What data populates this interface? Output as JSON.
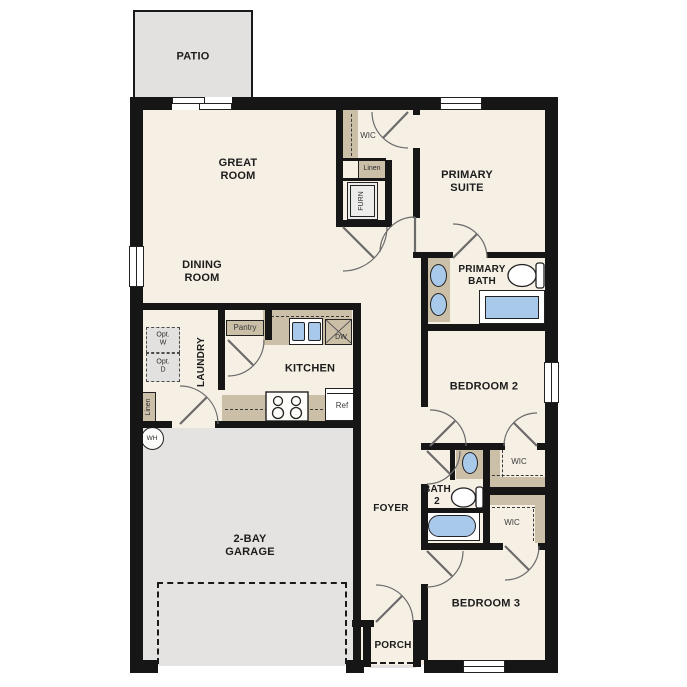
{
  "plan": {
    "title": "single-story floor plan",
    "colors": {
      "wall": "#161616",
      "floor": "#f5efe4",
      "exterior_concrete": "#e2e1df",
      "cabinetry_tan": "#cbbfa8",
      "plumbing_blue": "#a9c9ea",
      "label_text": "#1c1c1c"
    },
    "labels": {
      "patio": "PATIO",
      "great_room": "GREAT\nROOM",
      "dining_room": "DINING\nROOM",
      "primary_suite": "PRIMARY\nSUITE",
      "primary_bath": "PRIMARY\nBATH",
      "wic_primary": "WIC",
      "linen_hall": "Linen",
      "furnace": "FURN",
      "bedroom2": "BEDROOM 2",
      "wic_bedroom2": "WIC",
      "bath2": "BATH\n2",
      "foyer": "FOYER",
      "wic_bedroom3": "WIC",
      "bedroom3": "BEDROOM 3",
      "porch": "PORCH",
      "kitchen": "KITCHEN",
      "pantry": "Pantry",
      "laundry": "LAUNDRY",
      "opt_washer": "Opt.\nW",
      "opt_dryer": "Opt.\nD",
      "linen_laundry": "Linen",
      "water_heater": "WH",
      "refrigerator": "Ref",
      "dishwasher": "DW",
      "garage": "2-BAY\nGARAGE"
    }
  }
}
